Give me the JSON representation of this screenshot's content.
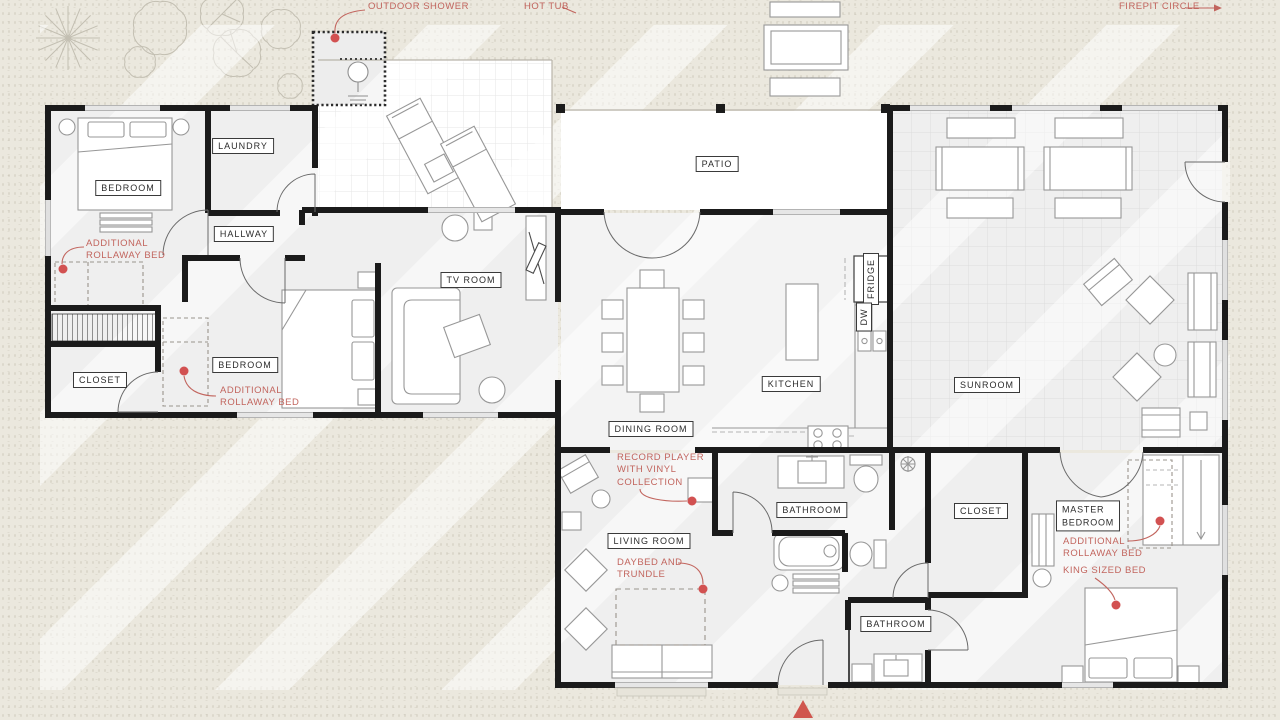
{
  "palette": {
    "page_background": "#ebe8de",
    "room_fill": "#efefef",
    "deck_fill": "#ffffff",
    "wall_color": "#1b1b1b",
    "furniture_stroke": "#979797",
    "label_text": "#2b2b2b",
    "accent_red": "#c2655e",
    "marker_red": "#d25151"
  },
  "site_labels": {
    "outdoor_shower": "OUTDOOR SHOWER",
    "hot_tub": "HOT TUB",
    "firepit_circle": "FIREPIT CIRCLE"
  },
  "rooms": {
    "bedroom_top_left": "BEDROOM",
    "laundry": "LAUNDRY",
    "hallway": "HALLWAY",
    "closet_left": "CLOSET",
    "bedroom_second": "BEDROOM",
    "tv_room": "TV ROOM",
    "patio": "PATIO",
    "dining_room": "DINING ROOM",
    "kitchen": "KITCHEN",
    "fridge": "FRIDGE",
    "dishwasher": "DW",
    "sunroom": "SUNROOM",
    "living_room": "LIVING ROOM",
    "bathroom_upper": "BATHROOM",
    "closet_master": "CLOSET",
    "master_bedroom": "MASTER BEDROOM",
    "bathroom_lower": "BATHROOM"
  },
  "annotations": {
    "rollaway_bedroom1": "ADDITIONAL ROLLAWAY BED",
    "rollaway_bedroom2": "ADDITIONAL ROLLAWAY BED",
    "record_player": "RECORD PLAYER WITH VINYL COLLECTION",
    "daybed": "DAYBED AND TRUNDLE",
    "rollaway_master": "ADDITIONAL ROLLAWAY BED",
    "king_bed": "KING SIZED BED"
  }
}
